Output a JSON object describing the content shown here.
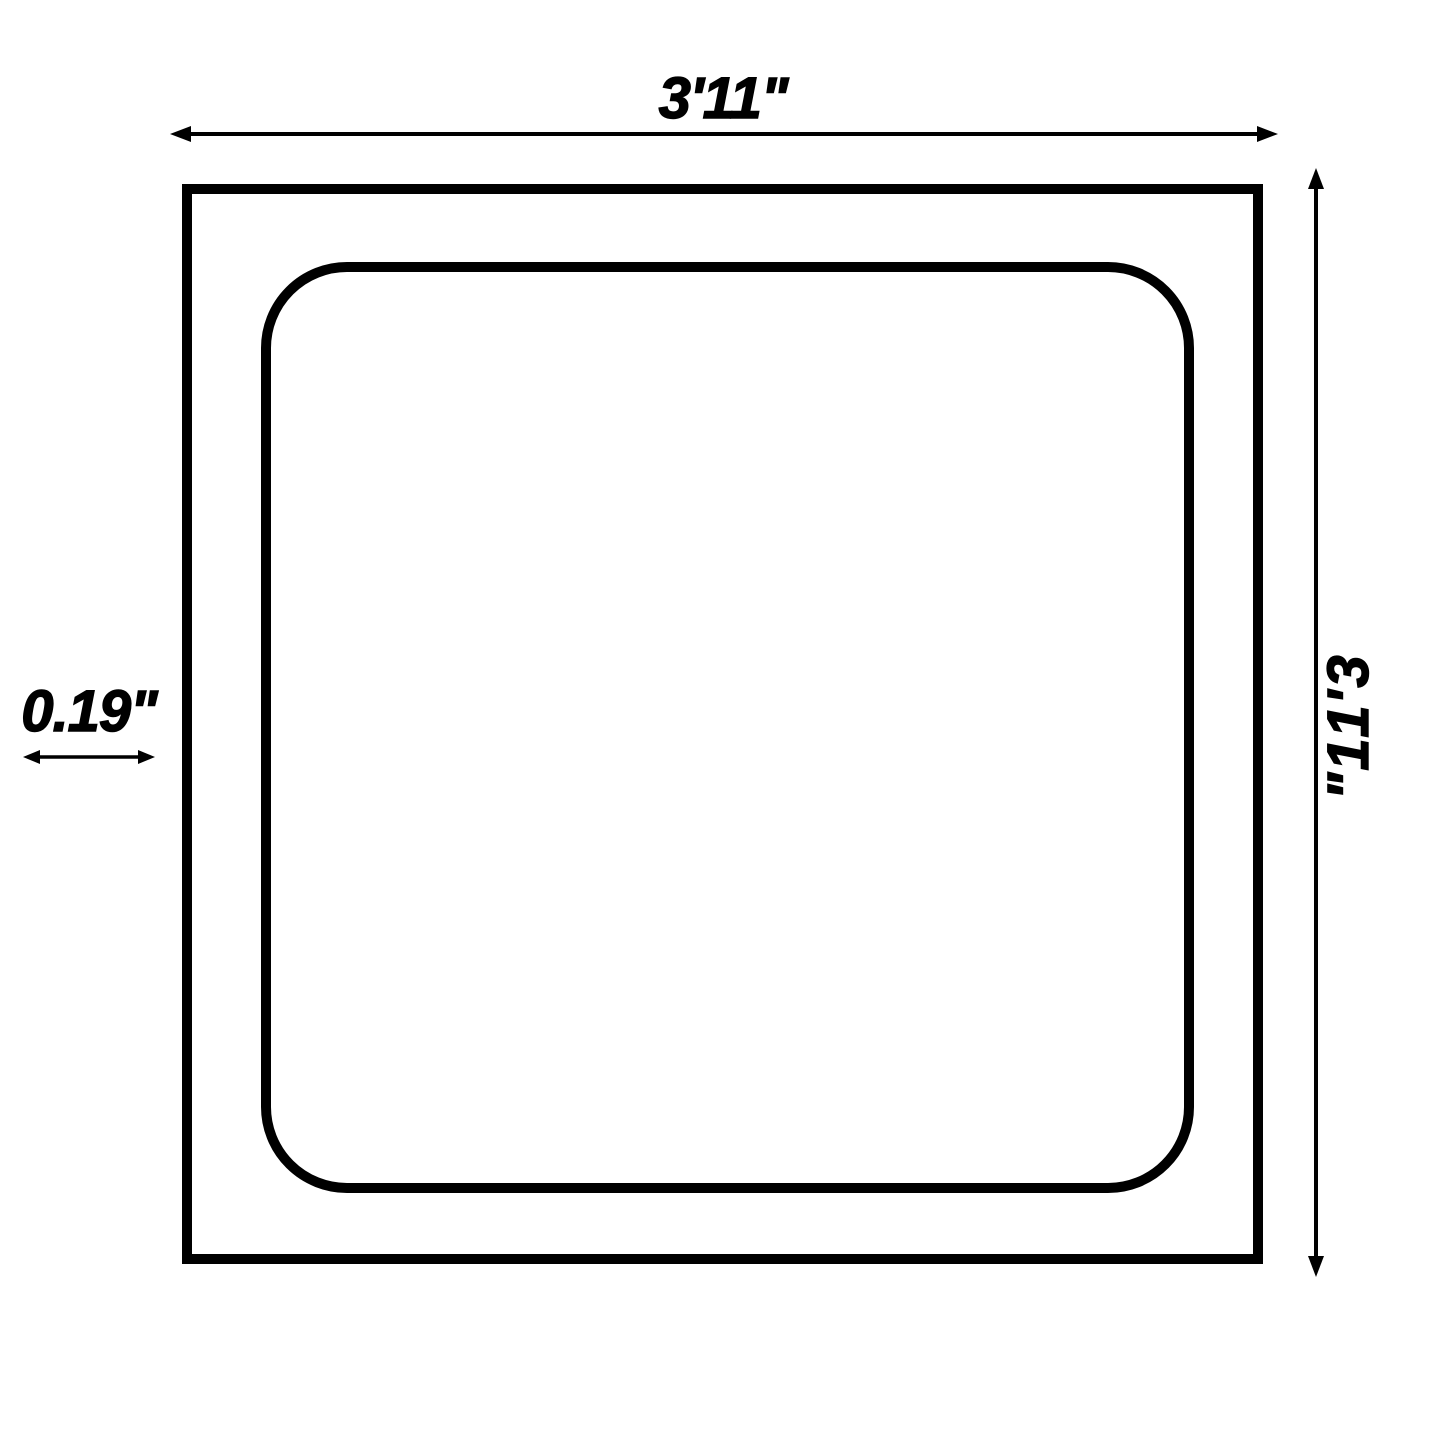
{
  "diagram": {
    "background_color": "#ffffff",
    "line_color": "#000000",
    "dimensions": {
      "width_label": "3'11\"",
      "height_label": "3'11\"",
      "thickness_label": "0.19\""
    },
    "height_label_chars": [
      "3",
      "'",
      "1",
      "1",
      "\""
    ]
  }
}
